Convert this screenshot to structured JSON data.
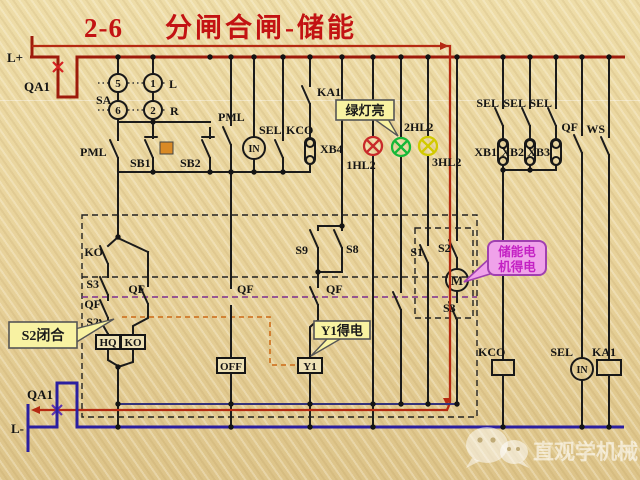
{
  "title": {
    "number": "2-6",
    "text": "分闸合闸-储能"
  },
  "labels": {
    "l_plus": "L+",
    "qa1_top": "QA1",
    "sa": "SA",
    "sa_5": "5",
    "sa_1": "1",
    "sa_6": "6",
    "sa_2": "2",
    "sa_l": "L",
    "sa_r": "R",
    "pml_left": "PML",
    "sb1": "SB1",
    "sb2": "SB2",
    "pml_mid": "PML",
    "sel_mid": "SEL",
    "kco_mid": "KCO",
    "in_mid": "IN",
    "ka1_top": "KA1",
    "xb4": "XB4",
    "hl2_1": "1HL2",
    "hl2_2": "2HL2",
    "hl2_3": "3HL2",
    "ko_contact": "KO",
    "s3_left": "S3",
    "qf_a": "QF",
    "s2_left": "S2",
    "qf_b": "QF",
    "qf_off": "QF",
    "s9": "S9",
    "s8": "S8",
    "qf_mid": "QF",
    "s1": "S1",
    "s2_right": "S2",
    "motor": "M",
    "s3_right": "S3",
    "hq": "HQ",
    "ko_coil": "KO",
    "off": "OFF",
    "y1": "Y1",
    "sel_r1": "SEL",
    "sel_r2": "SEL",
    "sel_r3": "SEL",
    "xb1": "XB1",
    "xb2": "XB2",
    "xb3": "XB3",
    "qf_right": "QF",
    "ws": "WS",
    "kco_coil": "KCO",
    "sel_bot": "SEL",
    "in_bot": "IN",
    "ka1_coil": "KA1",
    "qa1_bottom": "QA1",
    "l_minus": "L-"
  },
  "callouts": {
    "green_lamp": "绿灯亮",
    "y1_energized": "Y1得电",
    "s2_closed": "S2闭合",
    "motor_line1": "储能电",
    "motor_line2": "机得电"
  },
  "watermark": "直观学机械",
  "colors": {
    "title_red": "#c31313",
    "positive_bus_red": "#9e1b0b",
    "flow_path_red": "#b52a12",
    "negative_bus_blue": "#2b1fa0",
    "lamp_red": "#c92a2a",
    "lamp_green": "#17b838",
    "lamp_yellow": "#d2ca00",
    "callout_yellow_bg": "#f8f2a2",
    "callout_pink_bg": "#f0a2ea",
    "callout_pink_text": "#c421c4",
    "indicator_orange": "#d98a26"
  }
}
